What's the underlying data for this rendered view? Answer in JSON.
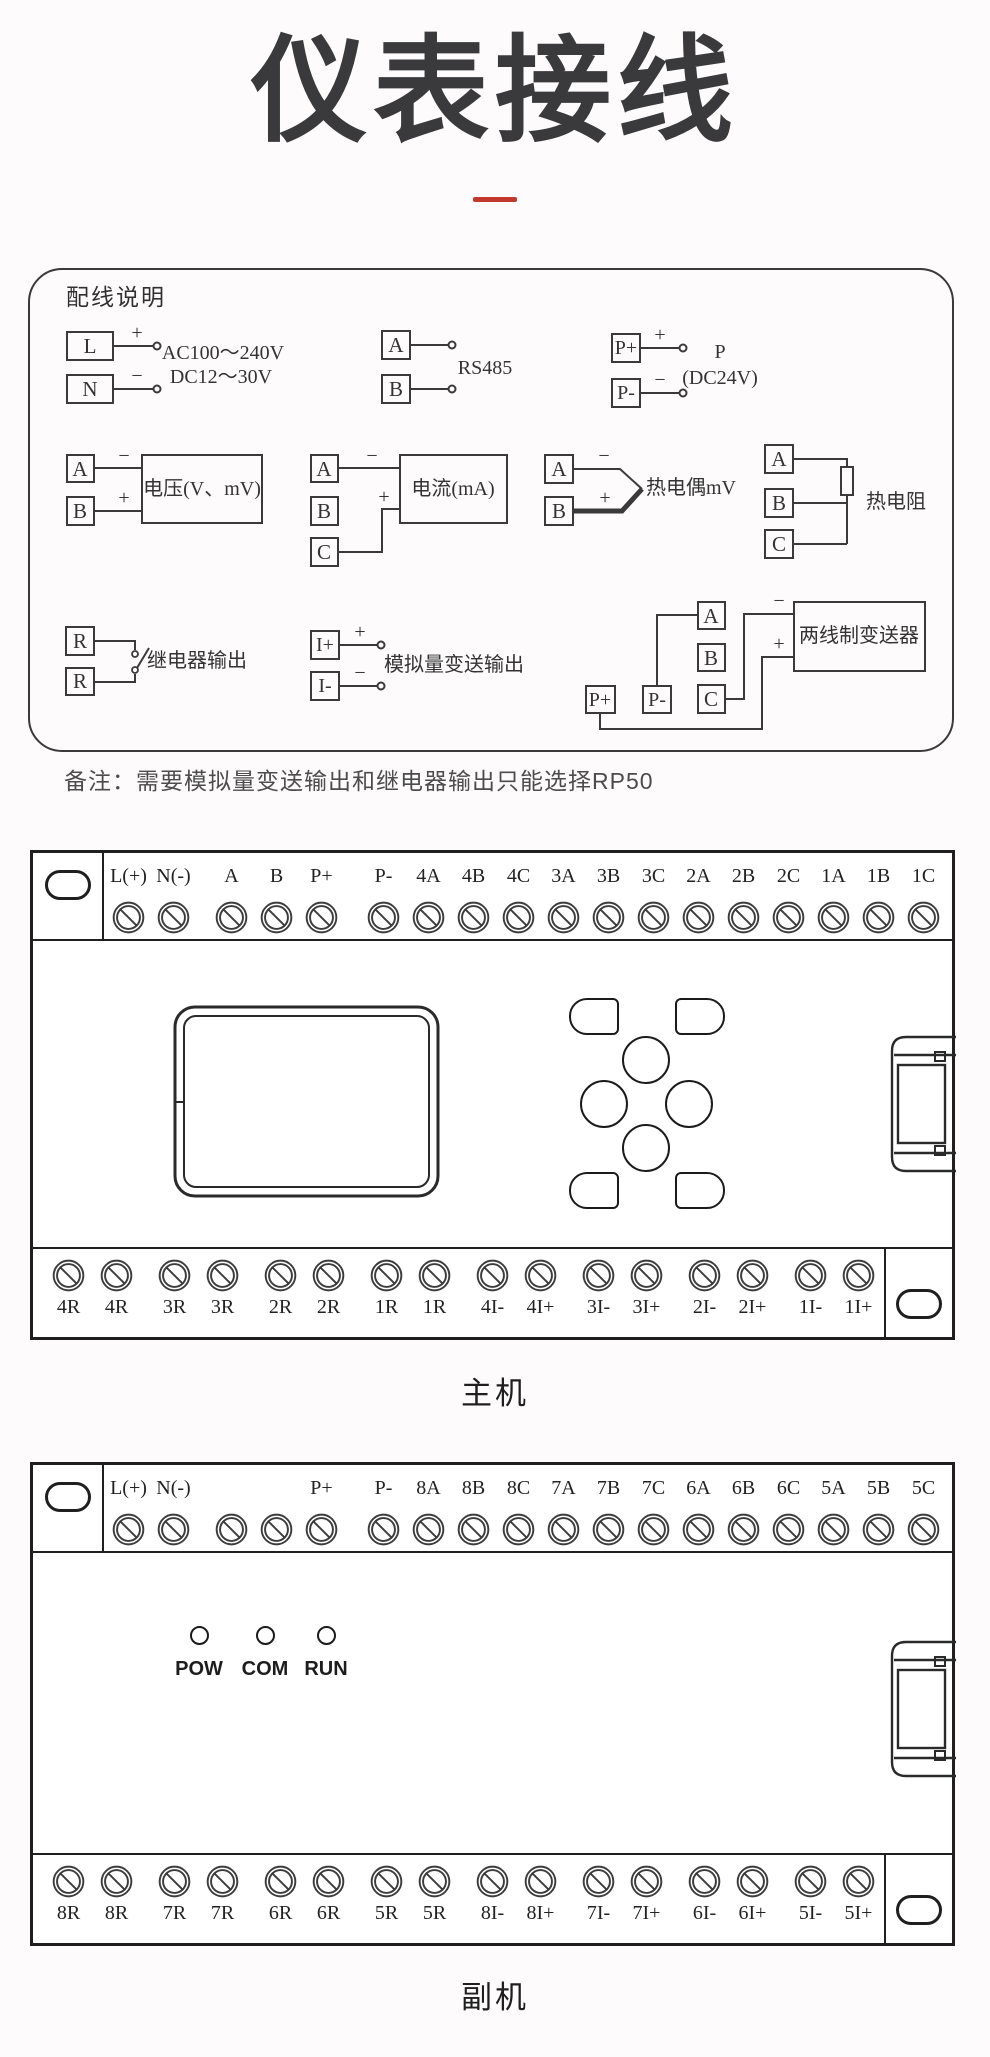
{
  "page": {
    "title": "仪表接线",
    "note": "备注：需要模拟量变送输出和继电器输出只能选择RP50"
  },
  "wiring_box": {
    "heading": "配线说明",
    "power": {
      "t1": "L",
      "t2": "N",
      "plus": "+",
      "minus": "−",
      "v1": "AC100～240V",
      "v2": "DC12～30V"
    },
    "rs485": {
      "t1": "A",
      "t2": "B",
      "label": "RS485"
    },
    "p24": {
      "t1": "P+",
      "t2": "P-",
      "plus": "+",
      "minus": "−",
      "l1": "P",
      "l2": "(DC24V)"
    },
    "voltage": {
      "t1": "A",
      "t2": "B",
      "minus": "−",
      "plus": "+",
      "label": "电压(V、mV)"
    },
    "current": {
      "t1": "A",
      "t2": "B",
      "t3": "C",
      "minus": "−",
      "plus": "+",
      "label": "电流(mA)"
    },
    "thermocouple": {
      "t1": "A",
      "t2": "B",
      "minus": "−",
      "plus": "+",
      "label": "热电偶mV"
    },
    "rtd": {
      "t1": "A",
      "t2": "B",
      "t3": "C",
      "label": "热电阻"
    },
    "relay": {
      "t1": "R",
      "t2": "R",
      "label": "继电器输出"
    },
    "analog_out": {
      "t1": "I+",
      "t2": "I-",
      "plus": "+",
      "minus": "−",
      "label": "模拟量变送输出"
    },
    "transmitter": {
      "t1": "A",
      "t2": "B",
      "t3": "C",
      "p_plus": "P+",
      "p_minus": "P-",
      "plus": "+",
      "minus": "−",
      "label": "两线制变送器"
    }
  },
  "main_unit": {
    "caption": "主机",
    "top_terminals": [
      "L(+)",
      "N(-)",
      "A",
      "B",
      "P+",
      "P-",
      "4A",
      "4B",
      "4C",
      "3A",
      "3B",
      "3C",
      "2A",
      "2B",
      "2C",
      "1A",
      "1B",
      "1C"
    ],
    "bottom_terminals": [
      "4R",
      "4R",
      "3R",
      "3R",
      "2R",
      "2R",
      "1R",
      "1R",
      "4I-",
      "4I+",
      "3I-",
      "3I+",
      "2I-",
      "2I+",
      "1I-",
      "1I+"
    ]
  },
  "sub_unit": {
    "caption": "副机",
    "leds": [
      "POW",
      "COM",
      "RUN"
    ],
    "top_terminals": [
      "L(+)",
      "N(-)",
      "",
      "",
      "P+",
      "P-",
      "8A",
      "8B",
      "8C",
      "7A",
      "7B",
      "7C",
      "6A",
      "6B",
      "6C",
      "5A",
      "5B",
      "5C"
    ],
    "bottom_terminals": [
      "8R",
      "8R",
      "7R",
      "7R",
      "6R",
      "6R",
      "5R",
      "5R",
      "8I-",
      "8I+",
      "7I-",
      "7I+",
      "6I-",
      "6I+",
      "5I-",
      "5I+"
    ]
  }
}
